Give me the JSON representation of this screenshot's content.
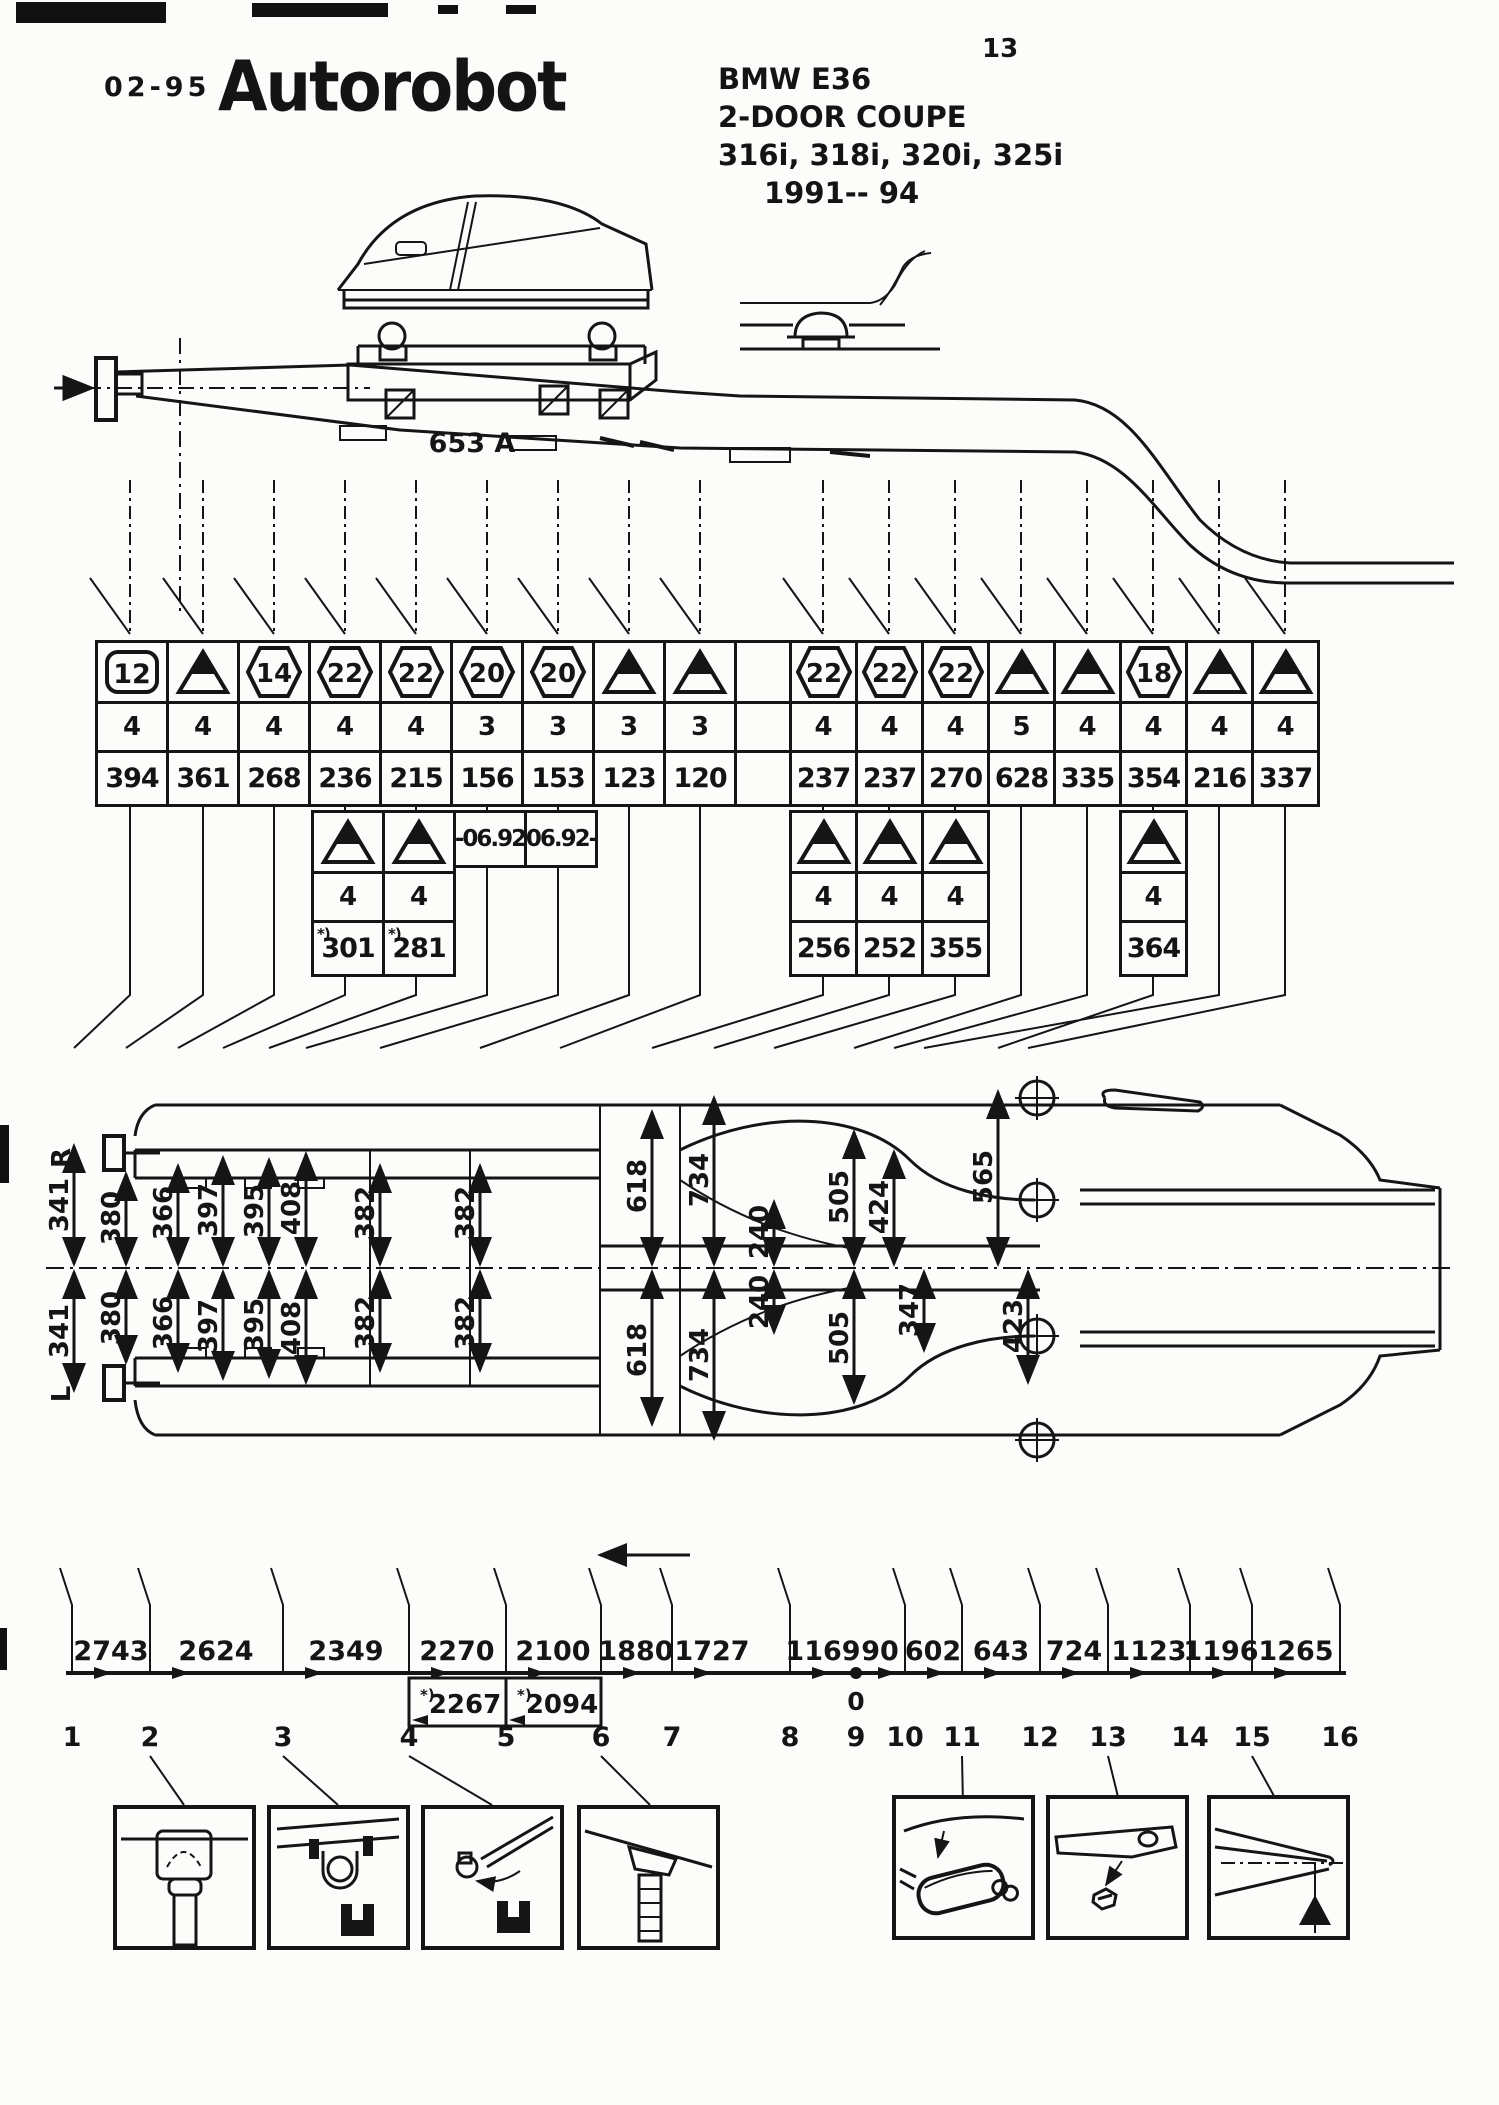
{
  "page": {
    "number": "13",
    "date_code": "02-95",
    "logo": "Autorobot"
  },
  "vehicle": {
    "model": "BMW E36",
    "body": "2-DOOR COUPE",
    "variants": "316i, 318i, 320i, 325i",
    "years": "1991-- 94"
  },
  "bench": {
    "label": "653 A"
  },
  "measurement_table": {
    "columns": [
      {
        "symbol": "box",
        "badge": "12",
        "level": "4",
        "value": "394"
      },
      {
        "symbol": "triangle",
        "badge": "",
        "level": "4",
        "value": "361"
      },
      {
        "symbol": "hex",
        "badge": "14",
        "level": "4",
        "value": "268"
      },
      {
        "symbol": "hex",
        "badge": "22",
        "level": "4",
        "value": "236"
      },
      {
        "symbol": "hex",
        "badge": "22",
        "level": "4",
        "value": "215"
      },
      {
        "symbol": "hex",
        "badge": "20",
        "level": "3",
        "value": "156"
      },
      {
        "symbol": "hex",
        "badge": "20",
        "level": "3",
        "value": "153"
      },
      {
        "symbol": "triangle",
        "badge": "",
        "level": "3",
        "value": "123"
      },
      {
        "symbol": "triangle",
        "badge": "",
        "level": "3",
        "value": "120"
      },
      {
        "symbol": "hex",
        "badge": "22",
        "level": "4",
        "value": "237"
      },
      {
        "symbol": "hex",
        "badge": "22",
        "level": "4",
        "value": "237"
      },
      {
        "symbol": "hex",
        "badge": "22",
        "level": "4",
        "value": "270"
      },
      {
        "symbol": "triangle",
        "badge": "",
        "level": "5",
        "value": "628"
      },
      {
        "symbol": "triangle",
        "badge": "",
        "level": "4",
        "value": "335"
      },
      {
        "symbol": "hex",
        "badge": "18",
        "level": "4",
        "value": "354"
      },
      {
        "symbol": "triangle",
        "badge": "",
        "level": "4",
        "value": "216"
      },
      {
        "symbol": "triangle",
        "badge": "",
        "level": "4",
        "value": "337"
      }
    ]
  },
  "sub_left": {
    "columns": [
      {
        "level": "4",
        "value": "301",
        "note": "*)"
      },
      {
        "level": "4",
        "value": "281",
        "note": "*)"
      }
    ],
    "date_notes": [
      "-06.92",
      "06.92-"
    ]
  },
  "sub_right": {
    "columns": [
      {
        "level": "4",
        "value": "256"
      },
      {
        "level": "4",
        "value": "252"
      },
      {
        "level": "4",
        "value": "355"
      }
    ],
    "single": {
      "level": "4",
      "value": "364"
    }
  },
  "plan": {
    "side_right": "R",
    "side_left": "L",
    "width_dims": [
      "341",
      "380",
      "366",
      "397",
      "395",
      "408",
      "382",
      "382"
    ],
    "rear_pairs": [
      "618",
      "734",
      "240",
      "505"
    ],
    "top_only": [
      "424",
      "565"
    ],
    "bottom_only": [
      "347",
      "423"
    ]
  },
  "scale": {
    "segments": [
      "2743",
      "2624",
      "2349",
      "2270",
      "2100",
      "1880",
      "1727",
      "1169",
      "90",
      "602",
      "643",
      "724",
      "1123",
      "1196",
      "1265"
    ],
    "alt": [
      {
        "value": "2267",
        "note": "*)"
      },
      {
        "value": "2094",
        "note": "*)"
      }
    ],
    "zero": "0",
    "stations": [
      "1",
      "2",
      "3",
      "4",
      "5",
      "6",
      "7",
      "8",
      "9",
      "10",
      "11",
      "12",
      "13",
      "14",
      "15",
      "16"
    ]
  }
}
